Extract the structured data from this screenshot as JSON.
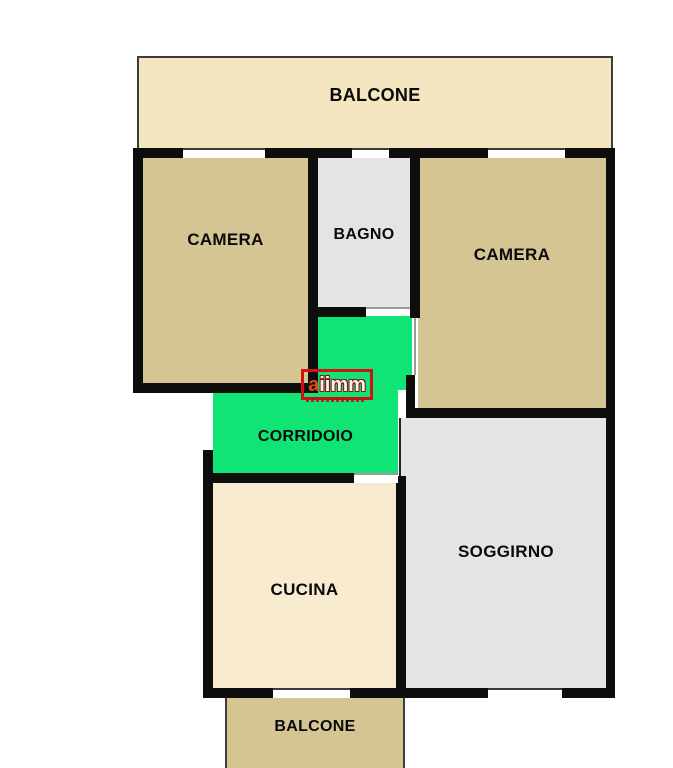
{
  "floorplan": {
    "background": "#ffffff",
    "wall_color": "#0d0d0d",
    "label_color": "#0a0a0a",
    "rooms": {
      "balcone_top": {
        "label": "BALCONE",
        "color": "#f5e6c2"
      },
      "camera_left": {
        "label": "CAMERA",
        "color": "#d5c593"
      },
      "bagno": {
        "label": "BAGNO",
        "color": "#e4e4e2"
      },
      "camera_right": {
        "label": "CAMERA",
        "color": "#d5c593"
      },
      "corridoio": {
        "label": "CORRIDOIO",
        "color": "#0fe474"
      },
      "cucina": {
        "label": "CUCINA",
        "color": "#f8ebcf"
      },
      "soggirno": {
        "label": "SOGGIRNO",
        "color": "#e4e4e2"
      },
      "balcone_bottom": {
        "label": "BALCONE",
        "color": "#d5c593"
      }
    },
    "watermark": {
      "first_letter": "a",
      "rest": "iimm",
      "accent_color": "#cf1212"
    }
  }
}
